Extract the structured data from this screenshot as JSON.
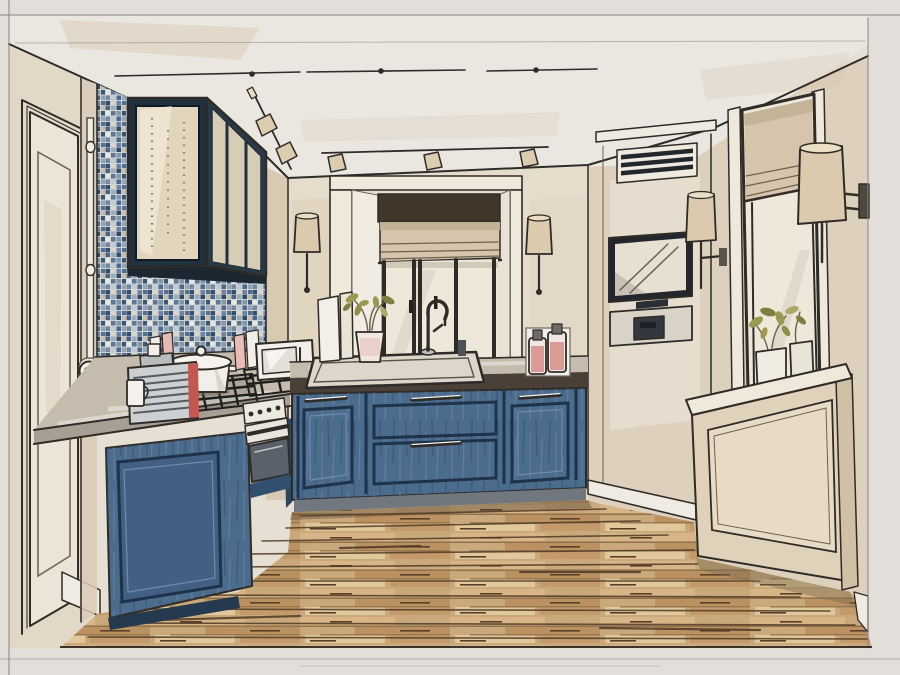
{
  "artwork": {
    "type": "hand-drawn interior design marker sketch",
    "subject": "U-shaped kitchen in one-point perspective with blue cabinets, mosaic backsplash, roman shades, track lighting and wood plank floor",
    "depicted_objects": [
      "entry door",
      "wall conduit with double outlet",
      "blue mosaic tile backsplash",
      "glass-front upper cabinet",
      "gas cooktop with pot",
      "espresso machine",
      "milk jug",
      "microwave",
      "built-in oven",
      "blue base cabinets with drawers",
      "stone countertop",
      "undermount sink with gooseneck faucet",
      "potted plant",
      "cutting boards",
      "oil bottles",
      "window alcove with roman shade",
      "pair of wall sconces",
      "ceiling track lighting",
      "ventilation grille",
      "built-in TV niche",
      "appliance niche",
      "tall window with roman shade",
      "window sill planters",
      "radiator cover",
      "wood plank floor",
      "pencil border frame"
    ]
  },
  "palette": {
    "paper": "#e2dfda",
    "sheet": "#e6dfd3",
    "ceiling": "#eae7e1",
    "wall_left": "#e3d8c6",
    "wall_strip": "#d8c9b2",
    "wall_back": "#e6dccb",
    "wall_right": "#ddd0bc",
    "trim_white": "#efe9dc",
    "door_leaf": "#ebe4d7",
    "cabinet_blue": "#4c6c8e",
    "cabinet_blue_dark": "#31506f",
    "cabinet_frame": "#1e3349",
    "counter_light": "#c5bcae",
    "counter_face": "#a79e94",
    "counter_fascia": "#4a4038",
    "shade_tan": "#d6c5ac",
    "sconce_shade": "#dccaae",
    "head_band": "#40362a",
    "window_glass": "#eee8da",
    "tv_frame": "#23272d",
    "appliance_dark": "#33383e",
    "espresso_red": "#c4574f",
    "bottle_pink": "#dc9a94",
    "plant_green": "#9a9851",
    "radiator_cream": "#e0d2ba",
    "toe_kick": "#70777f",
    "floor_dark_line": "#503a26",
    "outline": "#2f2b27"
  }
}
